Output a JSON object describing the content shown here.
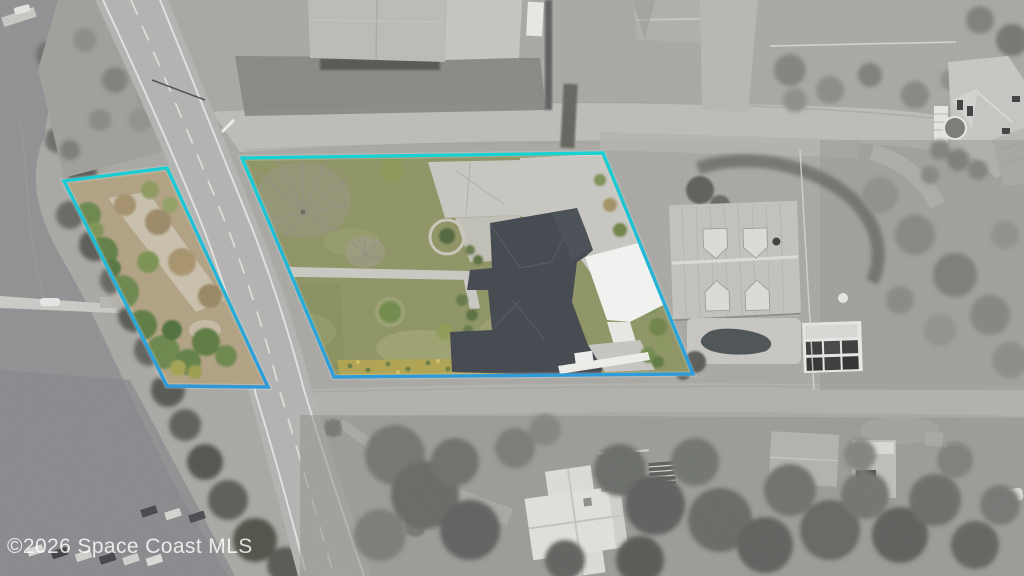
{
  "watermark": {
    "text": "©2026 Space Coast MLS"
  },
  "overlay": {
    "gradient_top": "#12d3d3",
    "gradient_bottom": "#2a96dc",
    "parcels": [
      {
        "id": "subject-lot",
        "points": "242,158 603,153 693,374 334,377"
      },
      {
        "id": "vacant-lot",
        "points": "64,181 167,168 268,387 167,386"
      }
    ]
  }
}
